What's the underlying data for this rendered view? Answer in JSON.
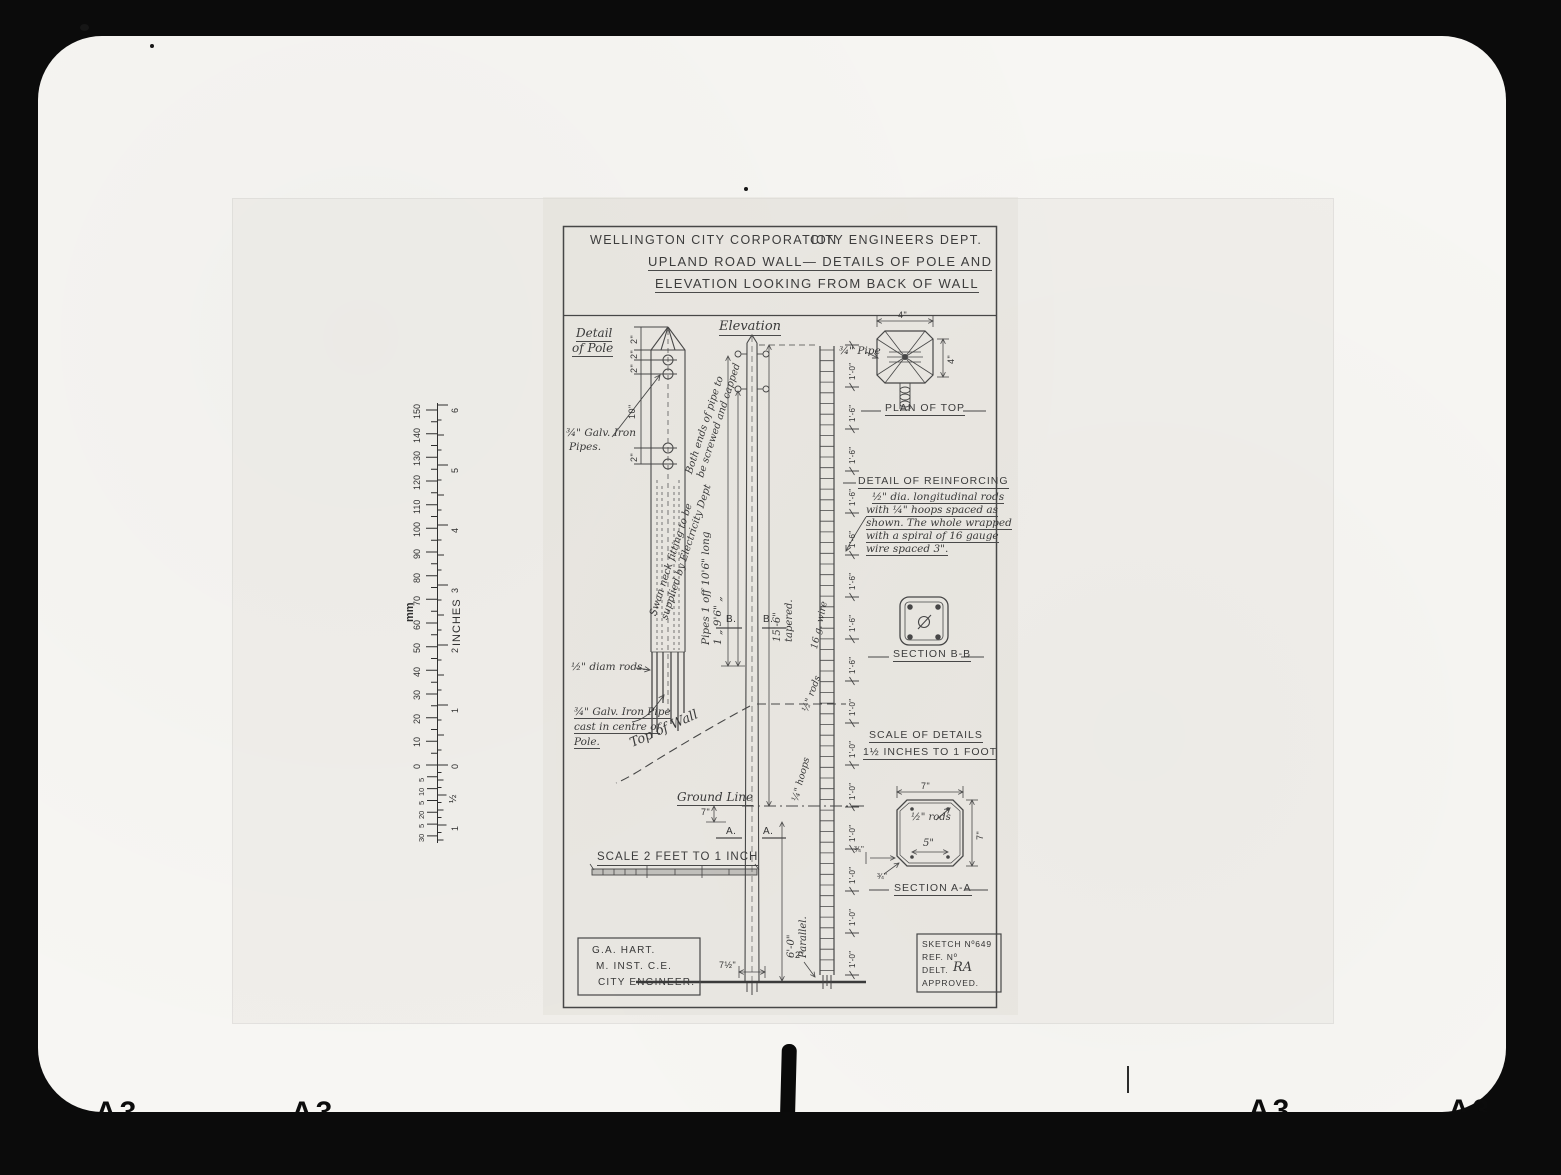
{
  "film": {
    "a3_marks": [
      "A3",
      "A3",
      "A3",
      "A3"
    ]
  },
  "ruler": {
    "mm_label": "mm",
    "inches_label": "INCHES",
    "mm_numbers": [
      "150",
      "140",
      "130",
      "120",
      "110",
      "100",
      "90",
      "80",
      "70",
      "60",
      "50",
      "40",
      "30",
      "20",
      "10",
      "0"
    ],
    "mm_sub_numbers": [
      "5",
      "10",
      "5",
      "20",
      "5",
      "30"
    ],
    "inch_numbers": [
      "6",
      "5",
      "4",
      "3",
      "2",
      "1",
      "0"
    ],
    "inch_sub_numbers": [
      "½",
      "1"
    ]
  },
  "title_block": {
    "organisation": "WELLINGTON CITY CORPORATION",
    "department": "CITY ENGINEERS DEPT.",
    "title_line1": "UPLAND ROAD WALL— DETAILS OF POLE AND",
    "title_line2": "ELEVATION LOOKING FROM BACK OF WALL"
  },
  "pole_detail": {
    "heading_line1": "Detail",
    "heading_line2": "of Pole",
    "label_pipes_line1": "¾\" Galv. Iron",
    "label_pipes_line2": "Pipes.",
    "label_rods": "½\" diam rods.",
    "label_pipe_cast_line1": "¾\" Galv. Iron Pipe",
    "label_pipe_cast_line2": "cast in centre of",
    "label_pipe_cast_line3": "Pole.",
    "dims": [
      "2\"",
      "2\"",
      "2\"",
      "10\"",
      "2\""
    ]
  },
  "elevation": {
    "heading": "Elevation",
    "note_pipe_ends_line1": "Both ends of pipe to",
    "note_pipe_ends_line2": "be screwed and capped",
    "note_swan_neck_line1": "Swan neck fitting to be",
    "note_swan_neck_line2": "supplied by Electricity Dept",
    "pipe_schedule_line1": "Pipes 1 off 10'6\" long",
    "pipe_schedule_line2": "1 „ 9'6\" „",
    "dim_tapered_line1": "15'-6\"",
    "dim_tapered_line2": "tapered.",
    "dim_parallel_line1": "6'-0\"",
    "dim_parallel_line2": "Parallel.",
    "label_top_of_wall": "Top of Wall",
    "label_ground_line": "Ground Line",
    "dim_ground": "7\"",
    "dim_pole_base": "7½\"",
    "dim_bottom": "2\"",
    "marker_b_left": "B.",
    "marker_b_right": "B.",
    "marker_a_left": "A.",
    "marker_a_right": "A.",
    "label_wire": "16 g. wire",
    "label_rods": "½\" rods",
    "label_hoops": "¼\" hoops",
    "spacing_dims": [
      "1'-0\"",
      "1'-6\"",
      "1'-6\"",
      "1'-6\"",
      "1'-6\"",
      "1'-6\"",
      "1'-6\"",
      "1'-6\"",
      "1'-0\"",
      "1'-0\"",
      "1'-0\"",
      "1'-0\"",
      "1'-0\"",
      "1'-0\"",
      "1'-0\""
    ]
  },
  "plan_of_top": {
    "caption": "PLAN OF TOP",
    "label_pipe": "¾\" Pipe",
    "dim_width": "4\"",
    "dim_height": "4\""
  },
  "reinforcing_note": {
    "heading": "DETAIL OF REINFORCING",
    "line1": "½\" dia. longitudinal rods",
    "line2": "with ¼\" hoops spaced as",
    "line3": "shown. The whole wrapped",
    "line4": "with a spiral of 16 gauge",
    "line5": "wire spaced 3\"."
  },
  "section_bb": {
    "caption": "SECTION B-B"
  },
  "scale_details": {
    "line1": "SCALE OF DETAILS",
    "line2": "1½ INCHES TO 1 FOOT"
  },
  "section_aa": {
    "caption": "SECTION A-A",
    "dim_width": "7\"",
    "dim_height": "7\"",
    "label_rods": "½\" rods",
    "dim_inner": "5\"",
    "dim_chamfer1": "¾\"",
    "dim_chamfer2": "¾\""
  },
  "main_scale": {
    "caption": "SCALE 2 FEET TO 1 INCH"
  },
  "engineer_block": {
    "line1": "G.A. HART.",
    "line2": "M. INST. C.E.",
    "line3": "CITY ENGINEER."
  },
  "sketch_block": {
    "sketch_no": "SKETCH Nº649",
    "ref_no": "REF. Nº",
    "delt_label": "DELT.",
    "delt_signature": "RA",
    "approved": "APPROVED."
  }
}
